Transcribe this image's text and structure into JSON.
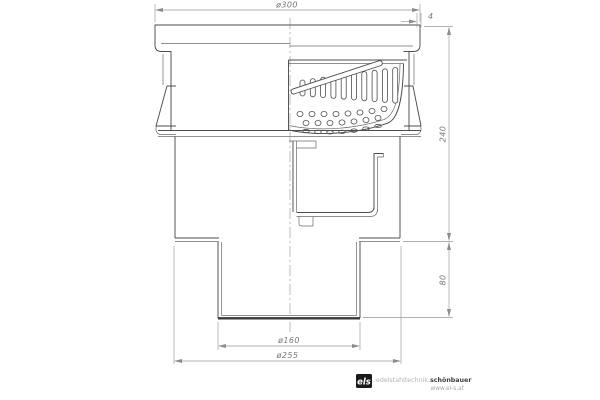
{
  "drawing": {
    "dimensions": {
      "top_diameter": "ø300",
      "edge_thickness": "4",
      "body_height": "240",
      "outlet_length": "80",
      "outlet_diameter": "ø160",
      "base_diameter": "ø255"
    }
  },
  "logo": {
    "mark": "els",
    "name_light": "edelstahltechnik.",
    "name_bold": "schönbauer",
    "website": "www.el-s.at"
  },
  "colors": {
    "line": "#4d4d4d",
    "dimension": "#979797",
    "dimension_text": "#777777",
    "background": "#ffffff",
    "logo_mark": "#1a1a1a"
  }
}
